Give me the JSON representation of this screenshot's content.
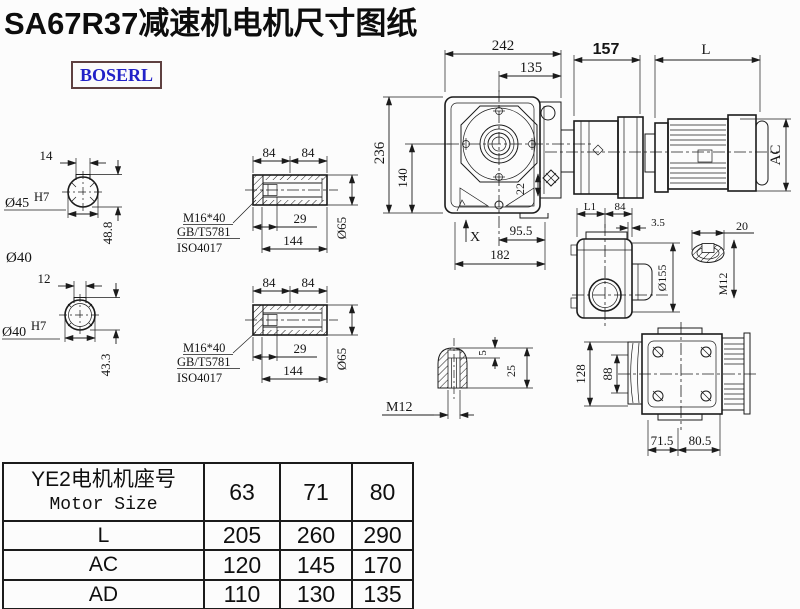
{
  "title": "SA67R37减速机电机尺寸图纸",
  "logo": "BOSERL",
  "drawing": {
    "shaft_section_top": {
      "key_width": "14",
      "bore_dia": "Ø45",
      "bore_tol": "H7",
      "key_height": "48.8",
      "od_label": "Ø40"
    },
    "shaft_section_bottom": {
      "key_width": "12",
      "bore_dia": "Ø40",
      "bore_tol": "H7",
      "key_height": "43.3"
    },
    "hollow_shaft_top": {
      "half_len_1": "84",
      "half_len_2": "84",
      "bolt": "M16*40",
      "std_gb": "GB/T5781",
      "std_iso": "ISO4017",
      "bolt_depth": "29",
      "length": "144",
      "dia": "Ø65"
    },
    "hollow_shaft_bottom": {
      "half_len_1": "84",
      "half_len_2": "84",
      "bolt": "M16*40",
      "std_gb": "GB/T5781",
      "std_iso": "ISO4017",
      "bolt_depth": "29",
      "length": "144",
      "dia": "Ø65"
    },
    "front_view": {
      "width": "242",
      "flange_width": "135",
      "height": "236",
      "center_to_base": "140",
      "plug_offset": "22",
      "foot_offset": "95.5",
      "base_width": "182",
      "surface_mark": "X"
    },
    "motor": {
      "adapter_length": "157",
      "motor_length": "L",
      "motor_dia": "AC"
    },
    "side_view": {
      "dim_l1": "L1",
      "dim_84": "84",
      "dim_3_5": "3.5",
      "flange_dia": "Ø155",
      "key_width": "20",
      "thread": "M12"
    },
    "shaft_end": {
      "key_depth": "5",
      "hole_depth": "25",
      "thread": "M12"
    },
    "flange_view": {
      "height": "128",
      "inner": "88",
      "foot_1": "71.5",
      "foot_2": "80.5"
    }
  },
  "table": {
    "header_cn": "YE2电机机座号",
    "header_en": "Motor Size",
    "sizes": [
      "63",
      "71",
      "80"
    ],
    "rows": [
      {
        "label": "L",
        "values": [
          "205",
          "260",
          "290"
        ]
      },
      {
        "label": "AC",
        "values": [
          "120",
          "145",
          "170"
        ]
      },
      {
        "label": "AD",
        "values": [
          "110",
          "130",
          "135"
        ]
      }
    ]
  }
}
